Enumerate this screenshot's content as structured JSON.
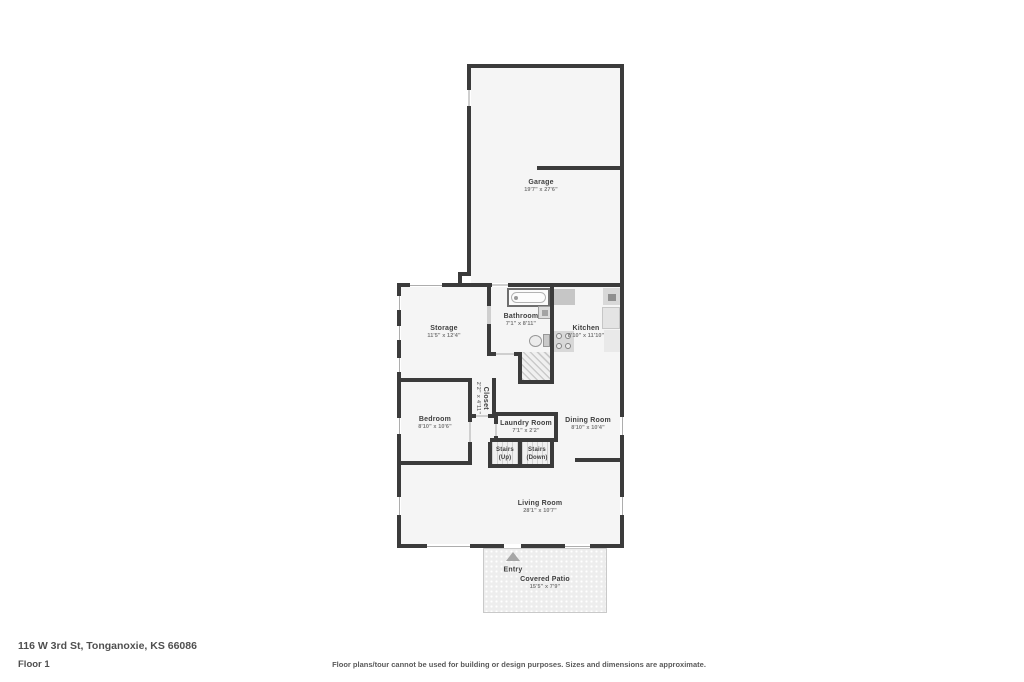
{
  "meta": {
    "address": "116 W 3rd St, Tonganoxie, KS 66086",
    "floor_label": "Floor 1",
    "disclaimer": "Floor plans/tour cannot be used for building or design purposes. Sizes and dimensions are approximate."
  },
  "colors": {
    "wall": "#3b3b3b",
    "room_fill": "#f5f5f5",
    "patio_fill": "#ededed",
    "text": "#3f3f3f",
    "dim_text": "#7a7a7a"
  },
  "rooms": {
    "garage": {
      "name": "Garage",
      "dims": "19'7\" x 27'6\""
    },
    "storage": {
      "name": "Storage",
      "dims": "11'5\" x 12'4\""
    },
    "bathroom": {
      "name": "Bathroom",
      "dims": "7'1\" x 8'11\""
    },
    "kitchen": {
      "name": "Kitchen",
      "dims": "8'10\" x 11'10\""
    },
    "bedroom": {
      "name": "Bedroom",
      "dims": "8'10\" x 10'6\""
    },
    "closet": {
      "name": "Closet",
      "dims": "2'2\" x 4'11\""
    },
    "laundry": {
      "name": "Laundry Room",
      "dims": "7'1\" x 2'2\""
    },
    "stairs_up": {
      "name": "Stairs",
      "dims": "(Up)"
    },
    "stairs_down": {
      "name": "Stairs",
      "dims": "(Down)"
    },
    "dining": {
      "name": "Dining Room",
      "dims": "8'10\" x 10'4\""
    },
    "living": {
      "name": "Living Room",
      "dims": "28'1\" x 10'7\""
    },
    "entry": {
      "name": "Entry"
    },
    "patio": {
      "name": "Covered Patio",
      "dims": "15'5\" x 7'9\""
    }
  }
}
